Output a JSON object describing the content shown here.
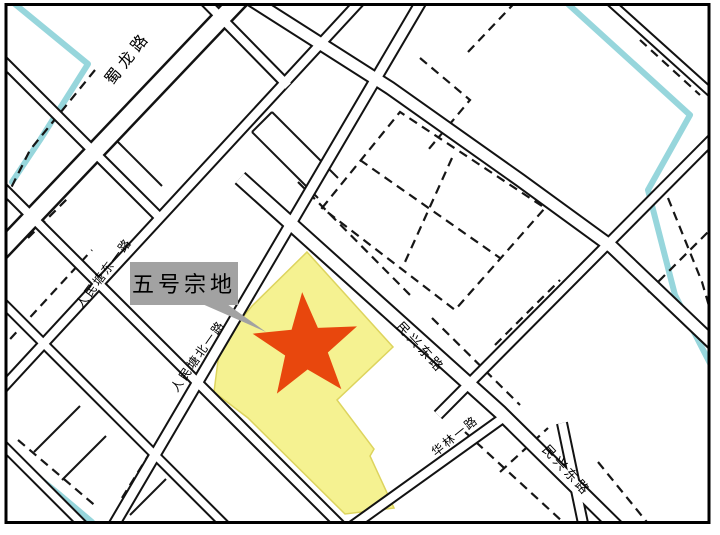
{
  "map": {
    "callout": {
      "label": "五号宗地"
    },
    "road_labels": {
      "shulong": "蜀龙路",
      "renmintang_dong_yilu": "人民塘东一路",
      "renmintang_bei_yilu": "人民塘北一路",
      "minxing_donglu_upper": "民兴东路",
      "minxing_donglu_lower": "民兴东路",
      "hualin_yilu": "华林一路"
    },
    "colors": {
      "parcel_fill": "#f5f291",
      "parcel_edge": "#ddd45e",
      "star": "#e8470d",
      "river": "#97d6dc",
      "callout_box": "#a2a2a2",
      "line": "#121212",
      "background": "#ffffff"
    }
  }
}
